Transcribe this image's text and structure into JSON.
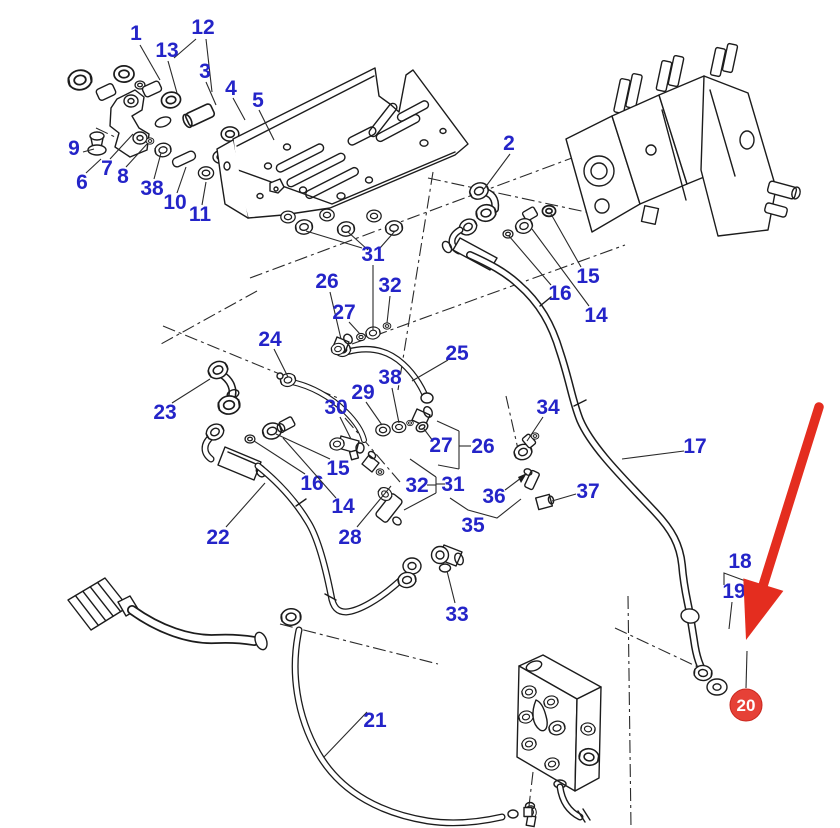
{
  "diagram": {
    "type": "exploded-parts-diagram",
    "subject": "hydraulic valve pipework exploded view",
    "canvas": {
      "width": 840,
      "height": 828,
      "background": "#ffffff"
    },
    "colors": {
      "line": "#1c1c1c",
      "label": "#2424c8",
      "arrow": "#e42d1f",
      "badge_fill": "#e64137",
      "badge_text": "#ffffff"
    },
    "badge": {
      "text": "20",
      "x": 746,
      "y": 705,
      "r": 16,
      "lead": [
        [
          747,
          651
        ],
        [
          746,
          688
        ]
      ]
    },
    "red_arrow": {
      "from": [
        819,
        407
      ],
      "to": [
        746,
        640
      ]
    },
    "callouts": [
      {
        "id": "1",
        "text": "1",
        "x": 136,
        "y": 33,
        "leads": [
          [
            [
              140,
              45
            ],
            [
              160,
              80
            ]
          ]
        ]
      },
      {
        "id": "12",
        "text": "12",
        "x": 203,
        "y": 27,
        "leads": [
          [
            [
              196,
              39
            ],
            [
              174,
              58
            ]
          ],
          [
            [
              206,
              39
            ],
            [
              212,
              92
            ]
          ]
        ]
      },
      {
        "id": "13",
        "text": "13",
        "x": 167,
        "y": 50,
        "leads": [
          [
            [
              168,
              61
            ],
            [
              177,
              93
            ]
          ]
        ]
      },
      {
        "id": "3",
        "text": "3",
        "x": 205,
        "y": 71,
        "leads": [
          [
            [
              206,
              82
            ],
            [
              216,
              105
            ]
          ]
        ]
      },
      {
        "id": "4",
        "text": "4",
        "x": 231,
        "y": 88,
        "leads": [
          [
            [
              233,
              98
            ],
            [
              245,
              120
            ]
          ]
        ]
      },
      {
        "id": "5",
        "text": "5",
        "x": 258,
        "y": 100,
        "leads": [
          [
            [
              259,
              110
            ],
            [
              274,
              140
            ]
          ]
        ]
      },
      {
        "id": "9",
        "text": "9",
        "x": 74,
        "y": 148,
        "leads": [
          [
            [
              83,
              152
            ],
            [
              94,
              149
            ]
          ]
        ]
      },
      {
        "id": "7",
        "text": "7",
        "x": 107,
        "y": 168,
        "leads": [
          [
            [
              110,
              159
            ],
            [
              133,
              134
            ]
          ]
        ]
      },
      {
        "id": "8",
        "text": "8",
        "x": 123,
        "y": 176,
        "leads": [
          [
            [
              126,
              167
            ],
            [
              147,
              144
            ]
          ]
        ]
      },
      {
        "id": "6",
        "text": "6",
        "x": 82,
        "y": 182,
        "leads": [
          [
            [
              86,
              173
            ],
            [
              101,
              159
            ]
          ]
        ]
      },
      {
        "id": "38a",
        "text": "38",
        "x": 152,
        "y": 188,
        "leads": [
          [
            [
              154,
              179
            ],
            [
              161,
              153
            ]
          ]
        ]
      },
      {
        "id": "10",
        "text": "10",
        "x": 175,
        "y": 202,
        "leads": [
          [
            [
              177,
              193
            ],
            [
              186,
              167
            ]
          ]
        ]
      },
      {
        "id": "11",
        "text": "11",
        "x": 200,
        "y": 214,
        "leads": [
          [
            [
              202,
              205
            ],
            [
              206,
              182
            ]
          ]
        ]
      },
      {
        "id": "2",
        "text": "2",
        "x": 509,
        "y": 143,
        "leads": [
          [
            [
              510,
              154
            ],
            [
              484,
              189
            ]
          ]
        ]
      },
      {
        "id": "15a",
        "text": "15",
        "x": 588,
        "y": 276,
        "leads": [
          [
            [
              581,
              267
            ],
            [
              551,
              214
            ]
          ]
        ]
      },
      {
        "id": "16a",
        "text": "16",
        "x": 560,
        "y": 293,
        "leads": [
          [
            [
              551,
              285
            ],
            [
              509,
              236
            ]
          ]
        ]
      },
      {
        "id": "14a",
        "text": "14",
        "x": 596,
        "y": 315,
        "leads": [
          [
            [
              589,
              306
            ],
            [
              532,
              229
            ]
          ]
        ]
      },
      {
        "id": "26a",
        "text": "26",
        "x": 327,
        "y": 281,
        "leads": [
          [
            [
              330,
              292
            ],
            [
              341,
              339
            ]
          ]
        ]
      },
      {
        "id": "27a",
        "text": "27",
        "x": 344,
        "y": 312,
        "leads": [
          [
            [
              349,
              322
            ],
            [
              360,
              334
            ]
          ]
        ]
      },
      {
        "id": "31a",
        "text": "31",
        "x": 373,
        "y": 254,
        "leads": [
          [
            [
              373,
              265
            ],
            [
              373,
              330
            ]
          ],
          [
            [
              306,
              231
            ],
            [
              362,
              248
            ]
          ],
          [
            [
              348,
              232
            ],
            [
              368,
              250
            ]
          ],
          [
            [
              395,
              231
            ],
            [
              380,
              248
            ]
          ]
        ]
      },
      {
        "id": "32a",
        "text": "32",
        "x": 390,
        "y": 285,
        "leads": [
          [
            [
              390,
              296
            ],
            [
              387,
              323
            ]
          ]
        ]
      },
      {
        "id": "25",
        "text": "25",
        "x": 457,
        "y": 353,
        "leads": [
          [
            [
              448,
              360
            ],
            [
              412,
              381
            ]
          ]
        ]
      },
      {
        "id": "24",
        "text": "24",
        "x": 270,
        "y": 339,
        "leads": [
          [
            [
              274,
              349
            ],
            [
              288,
              377
            ]
          ]
        ]
      },
      {
        "id": "38b",
        "text": "38",
        "x": 390,
        "y": 377,
        "leads": [
          [
            [
              392,
              388
            ],
            [
              399,
              423
            ]
          ]
        ]
      },
      {
        "id": "29",
        "text": "29",
        "x": 363,
        "y": 392,
        "leads": [
          [
            [
              366,
              402
            ],
            [
              382,
              425
            ]
          ]
        ]
      },
      {
        "id": "30",
        "text": "30",
        "x": 336,
        "y": 407,
        "leads": [
          [
            [
              340,
              417
            ],
            [
              351,
              439
            ]
          ]
        ]
      },
      {
        "id": "23",
        "text": "23",
        "x": 165,
        "y": 412,
        "leads": [
          [
            [
              172,
              403
            ],
            [
              210,
              379
            ]
          ]
        ]
      },
      {
        "id": "34",
        "text": "34",
        "x": 548,
        "y": 407,
        "leads": [
          [
            [
              543,
              417
            ],
            [
              527,
              441
            ]
          ]
        ]
      },
      {
        "id": "27b",
        "text": "27",
        "x": 441,
        "y": 445,
        "leads": [
          [
            [
              433,
              441
            ],
            [
              424,
              429
            ]
          ]
        ]
      },
      {
        "id": "26b",
        "text": "26",
        "x": 483,
        "y": 446,
        "leads": [
          [
            [
              471,
              446
            ],
            [
              459,
              446
            ]
          ],
          [
            [
              459,
              431
            ],
            [
              459,
              469
            ]
          ],
          [
            [
              459,
              431
            ],
            [
              437,
              421
            ]
          ],
          [
            [
              459,
              469
            ],
            [
              438,
              465
            ]
          ]
        ]
      },
      {
        "id": "15b",
        "text": "15",
        "x": 338,
        "y": 468,
        "leads": [
          [
            [
              330,
              459
            ],
            [
              276,
              434
            ]
          ]
        ]
      },
      {
        "id": "16b",
        "text": "16",
        "x": 312,
        "y": 483,
        "leads": [
          [
            [
              305,
              474
            ],
            [
              254,
              441
            ]
          ]
        ]
      },
      {
        "id": "14b",
        "text": "14",
        "x": 343,
        "y": 506,
        "leads": [
          [
            [
              336,
              498
            ],
            [
              283,
              438
            ]
          ]
        ]
      },
      {
        "id": "32b",
        "text": "32",
        "x": 417,
        "y": 485,
        "leads": [
          [
            [
              427,
              485
            ],
            [
              436,
              485
            ]
          ]
        ]
      },
      {
        "id": "31b",
        "text": "31",
        "x": 453,
        "y": 484,
        "leads": [
          [
            [
              445,
              484
            ],
            [
              436,
              484
            ]
          ],
          [
            [
              436,
              477
            ],
            [
              436,
              493
            ]
          ],
          [
            [
              436,
              477
            ],
            [
              410,
              459
            ]
          ],
          [
            [
              436,
              493
            ],
            [
              404,
              510
            ]
          ]
        ]
      },
      {
        "id": "36",
        "text": "36",
        "x": 494,
        "y": 496,
        "leads": [
          [
            [
              505,
              490
            ],
            [
              521,
              478
            ]
          ]
        ]
      },
      {
        "id": "37",
        "text": "37",
        "x": 588,
        "y": 491,
        "leads": [
          [
            [
              576,
              494
            ],
            [
              552,
              501
            ]
          ]
        ]
      },
      {
        "id": "35",
        "text": "35",
        "x": 473,
        "y": 525,
        "leads": [
          [
            [
              450,
              498
            ],
            [
              468,
              510
            ],
            [
              497,
              518
            ],
            [
              521,
              499
            ]
          ]
        ]
      },
      {
        "id": "22",
        "text": "22",
        "x": 218,
        "y": 537,
        "leads": [
          [
            [
              226,
              527
            ],
            [
              265,
              483
            ]
          ]
        ]
      },
      {
        "id": "28",
        "text": "28",
        "x": 350,
        "y": 537,
        "leads": [
          [
            [
              357,
              527
            ],
            [
              391,
              486
            ]
          ]
        ]
      },
      {
        "id": "17",
        "text": "17",
        "x": 695,
        "y": 446,
        "leads": [
          [
            [
              684,
              451
            ],
            [
              622,
              459
            ]
          ]
        ]
      },
      {
        "id": "18",
        "text": "18",
        "x": 740,
        "y": 561,
        "leads": [
          [
            [
              724,
              585
            ],
            [
              724,
              573
            ],
            [
              751,
              583
            ],
            [
              751,
              595
            ]
          ]
        ]
      },
      {
        "id": "19",
        "text": "19",
        "x": 734,
        "y": 591,
        "leads": [
          [
            [
              732,
              602
            ],
            [
              729,
              629
            ]
          ]
        ]
      },
      {
        "id": "33",
        "text": "33",
        "x": 457,
        "y": 614,
        "leads": [
          [
            [
              455,
              603
            ],
            [
              447,
              571
            ]
          ]
        ]
      },
      {
        "id": "21",
        "text": "21",
        "x": 375,
        "y": 720,
        "leads": [
          [
            [
              367,
              712
            ],
            [
              324,
              757
            ]
          ]
        ]
      }
    ]
  }
}
